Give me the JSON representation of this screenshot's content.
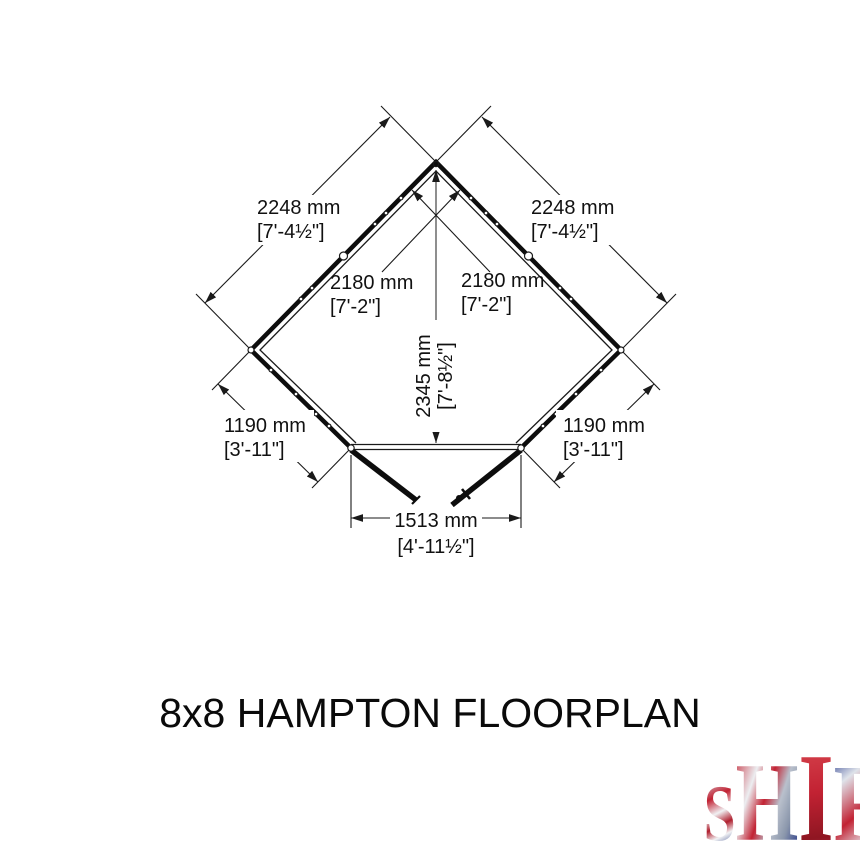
{
  "title": "8x8 HAMPTON FLOORPLAN",
  "floorplan": {
    "description": "Pentagonal corner-shed floorplan with open double doors at the front",
    "labels": {
      "left_wall": {
        "mm": "2248 mm",
        "imperial": "[7'-4½\"]"
      },
      "right_wall": {
        "mm": "2248 mm",
        "imperial": "[7'-4½\"]"
      },
      "interior_left": {
        "mm": "2180 mm",
        "imperial": "[7'-2\"]"
      },
      "interior_right": {
        "mm": "2180 mm",
        "imperial": "[7'-2\"]"
      },
      "depth": {
        "mm": "2345 mm",
        "imperial": "[7'-8½\"]"
      },
      "front_left": {
        "mm": "1190 mm",
        "imperial": "[3'-11\"]"
      },
      "front_right": {
        "mm": "1190 mm",
        "imperial": "[3'-11\"]"
      },
      "door_opening": {
        "mm": "1513 mm",
        "imperial": "[4'-11½\"]"
      }
    },
    "line_color": "#1a1a1a"
  },
  "logo": {
    "brand": "SHIRE",
    "letters": [
      "S",
      "H",
      "I",
      "R",
      "E"
    ],
    "tagline_words": [
      "BUILT",
      "AROUND",
      "OUR",
      "REPUTATION"
    ],
    "flag_palette": [
      "#c22233",
      "#ffffff",
      "#27377e",
      "#c9cdd4"
    ],
    "tagline_colors": [
      "#7b87a0",
      "#27376e",
      "#3a4f92",
      "#aa2f38"
    ]
  }
}
